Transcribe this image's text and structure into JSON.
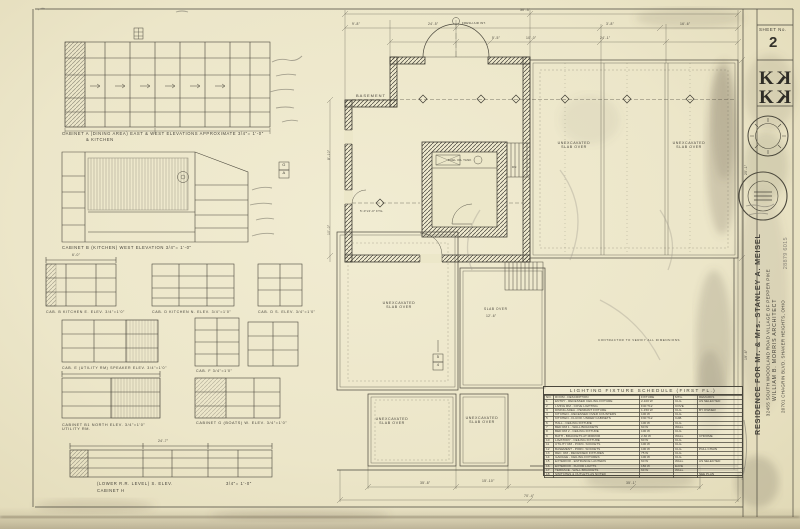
{
  "sheet": {
    "sheet_no_label": "SHEET No.",
    "sheet_number": "2",
    "title_block": {
      "project": "RESIDENCE FOR Mr. & Mrs. STANLEY A. MEISEL",
      "address": "32455 SOUTH WOODLAND ROAD        VILLAGE OF PEPPER PIKE",
      "architect": "WILLIAM B. MORRIS    ARCHITECT",
      "architect_address": "20701 CHAGRIN BLVD.      SHAKER HEIGHTS, OHIO",
      "handwritten_number": "28879  6015"
    }
  },
  "elevations": {
    "cab_a": "CABINET A (DINING AREA)    EAST & WEST ELEVATIONS   APPROXIMATE   3/4\"= 1'-0\"",
    "cab_a2": "& KITCHEN",
    "cab_b": "CABINET B (KITCHEN)     WEST ELEVATION     3/4\"= 1'-0\"",
    "cab_b_east": "CAB. B  KITCHEN  E. ELEV.  3/4\"=1'0\"",
    "cab_d_north": "CAB. D  KITCHEN  N. ELEV.  3/4\"=1'0\"",
    "cab_d_south": "CAB. D  S. ELEV.  3/4\"=1'0\"",
    "cab_e": "CAB. E (UTILITY RM)  SPEAKER ELEV.  3/4\"=1'0\"",
    "cab_f": "CAB. F   3/4\"=1'0\"",
    "cab_b1": "CABINET B1   NORTH ELEV.   3/4\"=1'0\"\nUTILITY RM.",
    "cab_g": "CABINET G (BOATS)   W. ELEV.   3/4\"=1'0\"",
    "cab_h_line1": "(LOWER R.R. LEVEL)    S. ELEV.",
    "cab_h_line2": "CABINET H",
    "cab_h_scale": "3/4\"= 1'-0\""
  },
  "plan": {
    "labels": {
      "basement": "BASEMENT",
      "unexcavated_1": "UNEXCAVATED\nSLAB OVER",
      "unexcavated_2": "UNEXCAVATED\nSLAB OVER",
      "unexcavated_3": "UNEXCAVATED\nSLAB OVER",
      "unexcavated_4": "UNEXCAVATED\nSLAB OVER",
      "unexcavated_5": "UNEXCAVATED\nSLAB OVER",
      "slab_over": "SLAB OVER",
      "contractor_note": "CONTRACTOR TO VERIFY ALL DIMENSIONS",
      "fresh_air": "FRESH AIR INT.",
      "footing_note": "5'-0\"x3'-0\" FTG.",
      "tank_room": "FUEL OIL TANK",
      "stair_dn": "DN"
    },
    "markers": {
      "section_top": "5",
      "section_bottom": "4",
      "detail_top": "G",
      "detail_bottom": "A"
    },
    "dims": {
      "d30_3": "30'-3\"",
      "d24_5": "24'-5\"",
      "d3_8": "3'-8\"",
      "d16_6": "16'-6\"",
      "d5_5": "5'-5\"",
      "d10_0": "10'-0\"",
      "d24_1": "24'-1\"",
      "d9_8": "9'-8\"",
      "d70_4": "70'-4\"",
      "d35_8": "35'-8\"",
      "d15_10": "15'-10\"",
      "d35_1": "35'-1\"",
      "d6_0": "6'-0\"",
      "d24_7": "24'-7\"",
      "d12_6": "12'-6\"",
      "r8_10": "8'-10\"",
      "r10_0": "10'-0\"",
      "r25_1": "25'-1\"",
      "r19_6": "19'-6\""
    }
  },
  "schedule": {
    "title": "LIGHTING FIXTURE SCHEDULE (FIRST FL.)",
    "columns": [
      "NO.",
      "ROOM  -  DESCRIPTION",
      "FIXTURE",
      "MTG.",
      "REMARKS"
    ],
    "rows": [
      [
        "1",
        "ENTRY - RECESSED CEILING FIXTURE",
        "2-100 W",
        "CLG.",
        "AS SELECTED"
      ],
      [
        "2",
        "LIVING RM - COVE LIGHTING",
        "F40 T12",
        "COVE",
        ""
      ],
      [
        "3",
        "DINING AREA - PENDANT FIXTURE",
        "1-150 W",
        "CLG.",
        "BY OWNER"
      ],
      [
        "4",
        "KITCHEN - RECESSED OVER COUNTERS",
        "100 W",
        "CLG.",
        ""
      ],
      [
        "5",
        "KITCHEN - FLUOR. UNDER CABINETS",
        "F30 T12",
        "CAB.",
        ""
      ],
      [
        "6",
        "HALL - CEILING FIXTURE",
        "100 W",
        "CLG.",
        ""
      ],
      [
        "7",
        "BED RM 1 - WALL BRACKETS",
        "60 W",
        "WALL",
        ""
      ],
      [
        "8",
        "BED RM 2 - CEILING FIXTURE",
        "100 W",
        "CLG.",
        ""
      ],
      [
        "9",
        "BATH - BRACKETS AT MIRROR",
        "2-60 W",
        "WALL",
        "CHROME"
      ],
      [
        "10",
        "LAVATORY - CEILING FIXTURE",
        "60 W",
        "CLG.",
        ""
      ],
      [
        "11",
        "UTILITY RM - PORC. SOCKETS",
        "100 W",
        "CLG.",
        ""
      ],
      [
        "12",
        "BASEMENT - PORC. SOCKETS",
        "100 W",
        "CLG.",
        "PULL CHAIN"
      ],
      [
        "13",
        "REC. RM - RECESSED FIXTURES",
        "75 W",
        "CLG.",
        ""
      ],
      [
        "14",
        "GARAGE - CEILING FIXTURES",
        "100 W",
        "CLG.",
        ""
      ],
      [
        "15",
        "EXTERIOR - ENTRANCE LANTERN",
        "60 W",
        "WALL",
        "AS SELECTED"
      ],
      [
        "16",
        "EXTERIOR - FLOOD LIGHTS",
        "150 W",
        "EAVE",
        ""
      ],
      [
        "17",
        "TERRACE - WALL BRACKETS",
        "60 W",
        "WALL",
        ""
      ],
      [
        "18",
        "SWITCHES & OUTLETS AS NOTED",
        "",
        "",
        "SEE PLAN"
      ]
    ]
  }
}
